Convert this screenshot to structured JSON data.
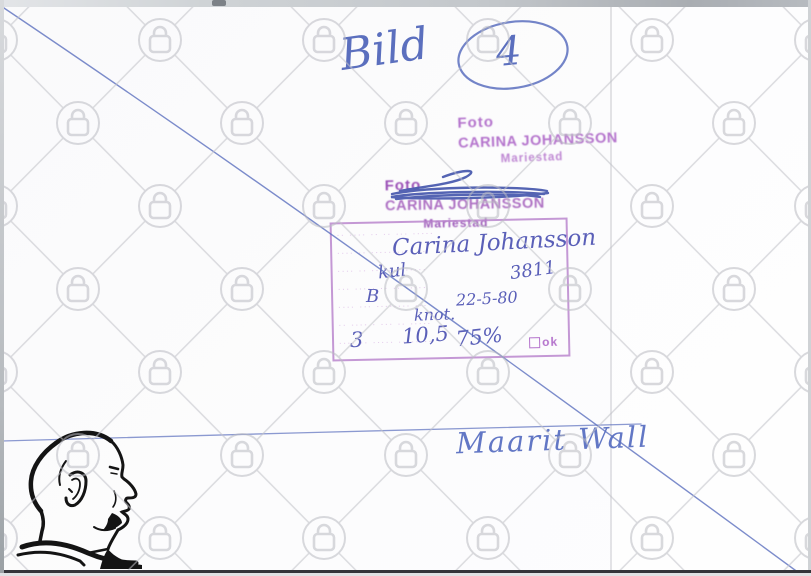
{
  "top_annotation": {
    "word": "Bild",
    "number": "4"
  },
  "stamp_top": {
    "line1": "Foto",
    "line2": "CARINA JOHANSSON",
    "line3": "Mariestad"
  },
  "stamp_crossed": {
    "line1": "Foto",
    "line2": "CARINA JOHANSSON",
    "line3": "Mariestad"
  },
  "form": {
    "rows": [
      "·· ···· ·· ·· ··· ·····",
      "···· ·· ·········· ··",
      "···· ·· ······· ·····",
      "··· ····· ·· ·· ·····",
      "···· ··· ········ ···",
      "·· ···· · ··· ·· ·····",
      "···· ·· ····· ········"
    ],
    "ok_label": "ok",
    "entries": {
      "name": "Carina Johansson",
      "label_left": "kul",
      "code": "3811",
      "letter": "B",
      "date": "22-5-80",
      "note": "knot.",
      "count": "3",
      "size": "10,5",
      "percent": "75%"
    }
  },
  "signature": "Maarit Wall",
  "watermark": {
    "icon": "padlock-icon",
    "color": "#b9bac1"
  },
  "pen_color": "#5b6fbe"
}
